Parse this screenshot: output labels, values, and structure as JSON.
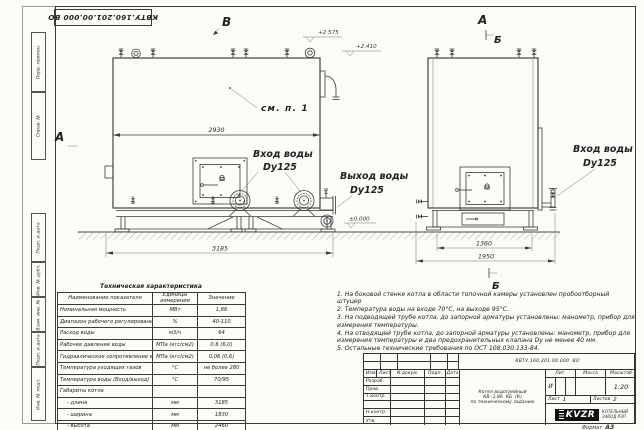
{
  "sheet": {
    "stamp_designation": "КВТУ.160.201.00.000 ВО",
    "format_label": "Формат",
    "format_value": "А3"
  },
  "frame_strip": {
    "cells": [
      "Перв. примен.",
      "Справ. №",
      "Подп. и дата",
      "Инв. № дубл.",
      "Взам. инв. №",
      "Подп. и дата",
      "Инв. № подл."
    ]
  },
  "drawing": {
    "view_b": "В",
    "view_a_top": "А",
    "section_b_top": "Б",
    "view_a_left": "А",
    "section_b_bottom": "Б",
    "see_note": "см. п. 1",
    "elev_top1": "+2.575",
    "elev_top2": "+2.410",
    "elev_zero": "±0.000",
    "dim_front_body": "2930",
    "dim_front_overall": "3185",
    "dim_side_inner": "1360",
    "dim_side_overall": "1950",
    "callout_inlet_front_1": "Вход воды",
    "callout_inlet_front_2": "Dy125",
    "callout_outlet_1": "Выход воды",
    "callout_outlet_2": "Dy125",
    "callout_inlet_side_1": "Вход воды",
    "callout_inlet_side_2": "Dy125"
  },
  "tech_table": {
    "title": "Техническая характеристика",
    "col_headers": [
      "Наименование показателя",
      "Единицы измерения",
      "Значение"
    ],
    "rows": [
      [
        "Номинальная мощность",
        "МВт",
        "1,86"
      ],
      [
        "Диапазон рабочего регулирования",
        "%",
        "40-110"
      ],
      [
        "Расход воды",
        "м3/ч",
        "64"
      ],
      [
        "Рабочее давление воды",
        "МПа (кгс/см2)",
        "0,6 (6,0)"
      ],
      [
        "Гидравлическое сопротивление котла",
        "МПа (кгс/см2)",
        "0,06 (0,6)"
      ],
      [
        "Температура уходящих газов",
        "°С",
        "не более 280"
      ],
      [
        "Температура воды (Вход/выход)",
        "°С",
        "70/95"
      ],
      [
        "Габариты котла",
        "",
        ""
      ],
      [
        "- длина",
        "мм",
        "3185"
      ],
      [
        "- ширина",
        "мм",
        "1830"
      ],
      [
        "- высота",
        "мм",
        "2460"
      ]
    ]
  },
  "notes": {
    "items": [
      "1. На боковой стенке котла в области топочной камеры установлен пробоотборный штуцер",
      "2. Температура воды на входе 70°С, на выходе 95°С.",
      "3. На подводящей трубе котла, до запорной арматуры установлены: манометр, прибор для измерения температуры.",
      "4. На отводящей трубе котла, до запорной арматуры установлены: манометр, прибор для измерения температуры и два предохранительных клапана  Dу не менее 40 мм.",
      "5. Остальные технические требования по ОСТ 108.030.133-84."
    ]
  },
  "title_block": {
    "designation": "КВТУ.160.201.00.000  ВО",
    "rev_cols": [
      "Изм.",
      "Лист",
      "N докум.",
      "Подп.",
      "Дата"
    ],
    "roles": [
      "Разраб.",
      "Пров.",
      "Т.контр.",
      "",
      "Н.контр.",
      "Утв."
    ],
    "name_line1": "Котел водогрейный",
    "name_line2": "КВ -1,86  КБ  (К)",
    "name_line3": "по техническому заданию",
    "lit_label": "Лит.",
    "mass_label": "Масса",
    "scale_label": "Масштаб",
    "lit_value": "И",
    "scale_value": "1:20",
    "sheet_label": "Лист",
    "sheet_num": "1",
    "sheets_label": "Листов",
    "sheets_num": "2",
    "logo_text": "KVZR",
    "company_line1": "КОТЕЛЬНЫЙ",
    "company_line2": "ЗАВОД РЭП"
  }
}
